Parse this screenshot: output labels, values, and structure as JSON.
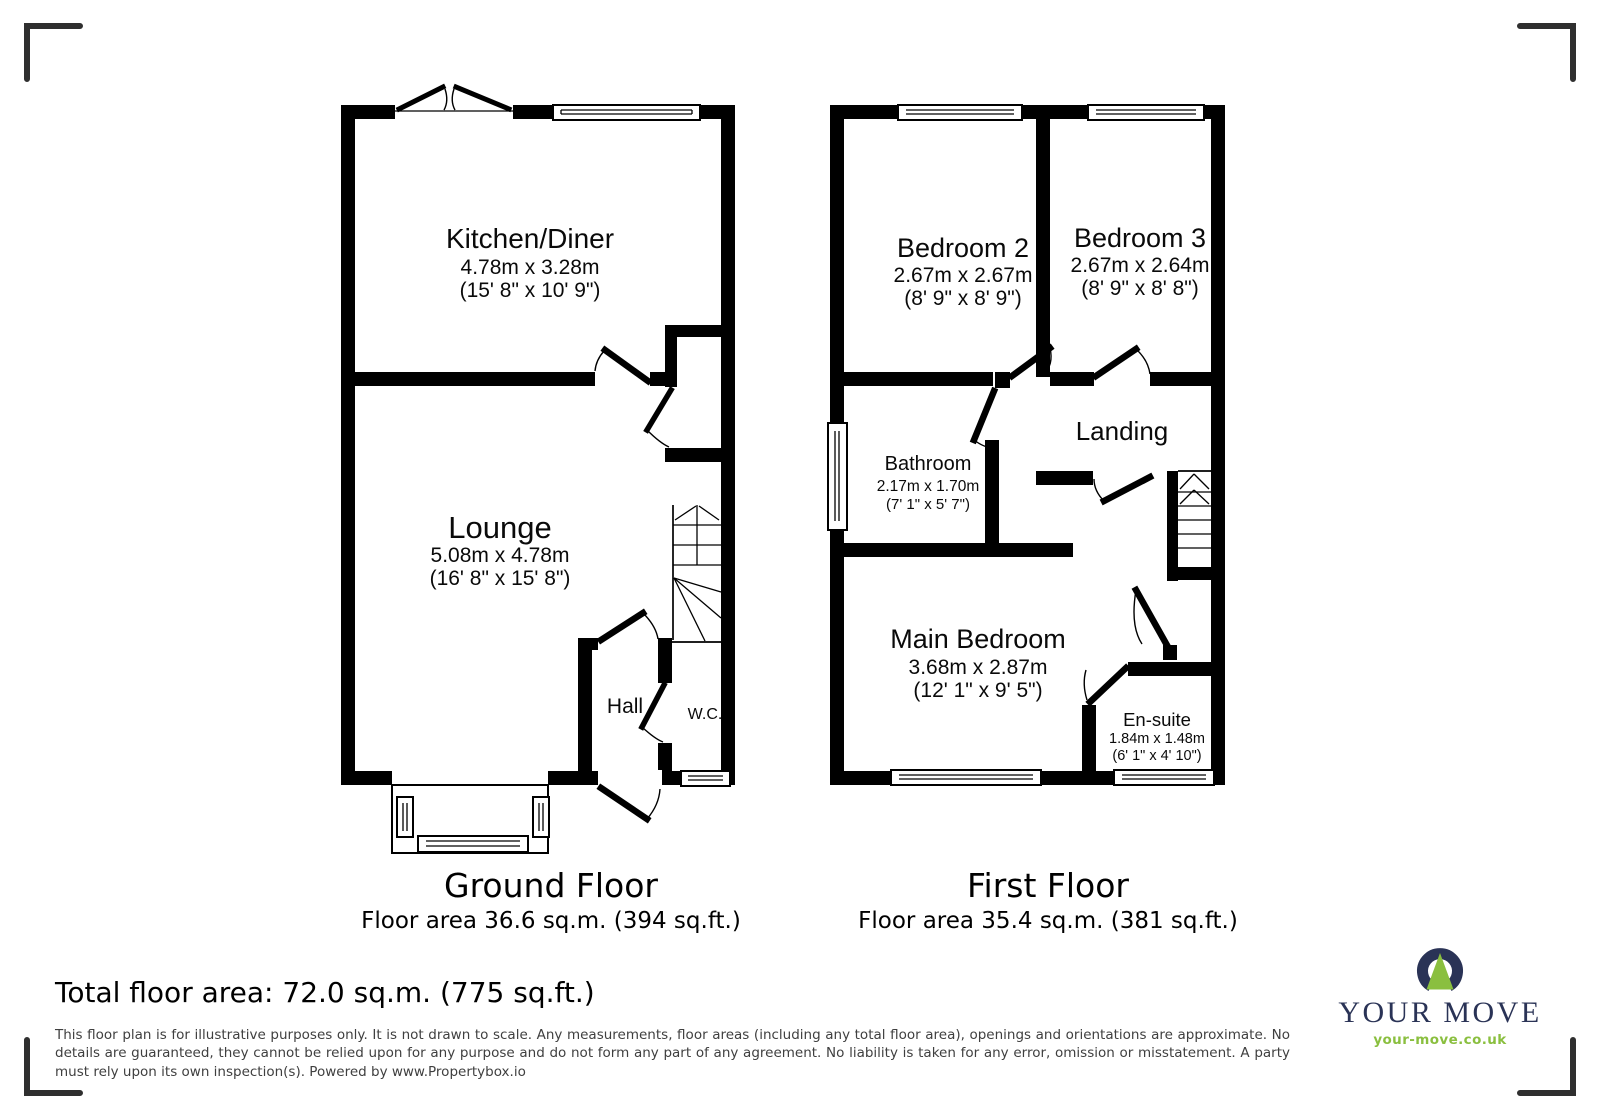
{
  "ground_floor": {
    "title": "Ground Floor",
    "area_label": "Floor area 36.6 sq.m. (394 sq.ft.)",
    "kitchen": {
      "name": "Kitchen/Diner",
      "metric": "4.78m x 3.28m",
      "imperial": "(15' 8\" x 10' 9\")"
    },
    "lounge": {
      "name": "Lounge",
      "metric": "5.08m x 4.78m",
      "imperial": "(16' 8\" x 15' 8\")"
    },
    "hall": {
      "name": "Hall"
    },
    "wc": {
      "name": "W.C."
    }
  },
  "first_floor": {
    "title": "First Floor",
    "area_label": "Floor area 35.4 sq.m. (381 sq.ft.)",
    "bedroom2": {
      "name": "Bedroom 2",
      "metric": "2.67m x 2.67m",
      "imperial": "(8' 9\" x 8' 9\")"
    },
    "bedroom3": {
      "name": "Bedroom 3",
      "metric": "2.67m x 2.64m",
      "imperial": "(8' 9\" x 8' 8\")"
    },
    "bathroom": {
      "name": "Bathroom",
      "metric": "2.17m x 1.70m",
      "imperial": "(7' 1\" x 5' 7\")"
    },
    "landing": {
      "name": "Landing"
    },
    "main_bedroom": {
      "name": "Main Bedroom",
      "metric": "3.68m x 2.87m",
      "imperial": "(12' 1\" x 9' 5\")"
    },
    "ensuite": {
      "name": "En-suite",
      "metric": "1.84m x 1.48m",
      "imperial": "(6' 1\" x 4' 10\")"
    }
  },
  "footer": {
    "total_area": "Total floor area: 72.0 sq.m. (775 sq.ft.)",
    "disclaimer": "This floor plan is for illustrative purposes only. It is not drawn to scale. Any measurements, floor areas (including any total floor area), openings and orientations are approximate. No details are guaranteed, they cannot be relied upon for any purpose and do not form any part of any agreement. No liability is taken for any error, omission or misstatement. A party must rely upon its own inspection(s). Powered by www.Propertybox.io"
  },
  "logo": {
    "brand": "YOUR MOVE",
    "website": "your-move.co.uk"
  },
  "colors": {
    "wall": "#000000",
    "corner_marks": "#2f2f2f",
    "logo_navy": "#2a3356",
    "logo_green": "#8abf3f",
    "disclaimer_text": "#3f3f3f"
  }
}
